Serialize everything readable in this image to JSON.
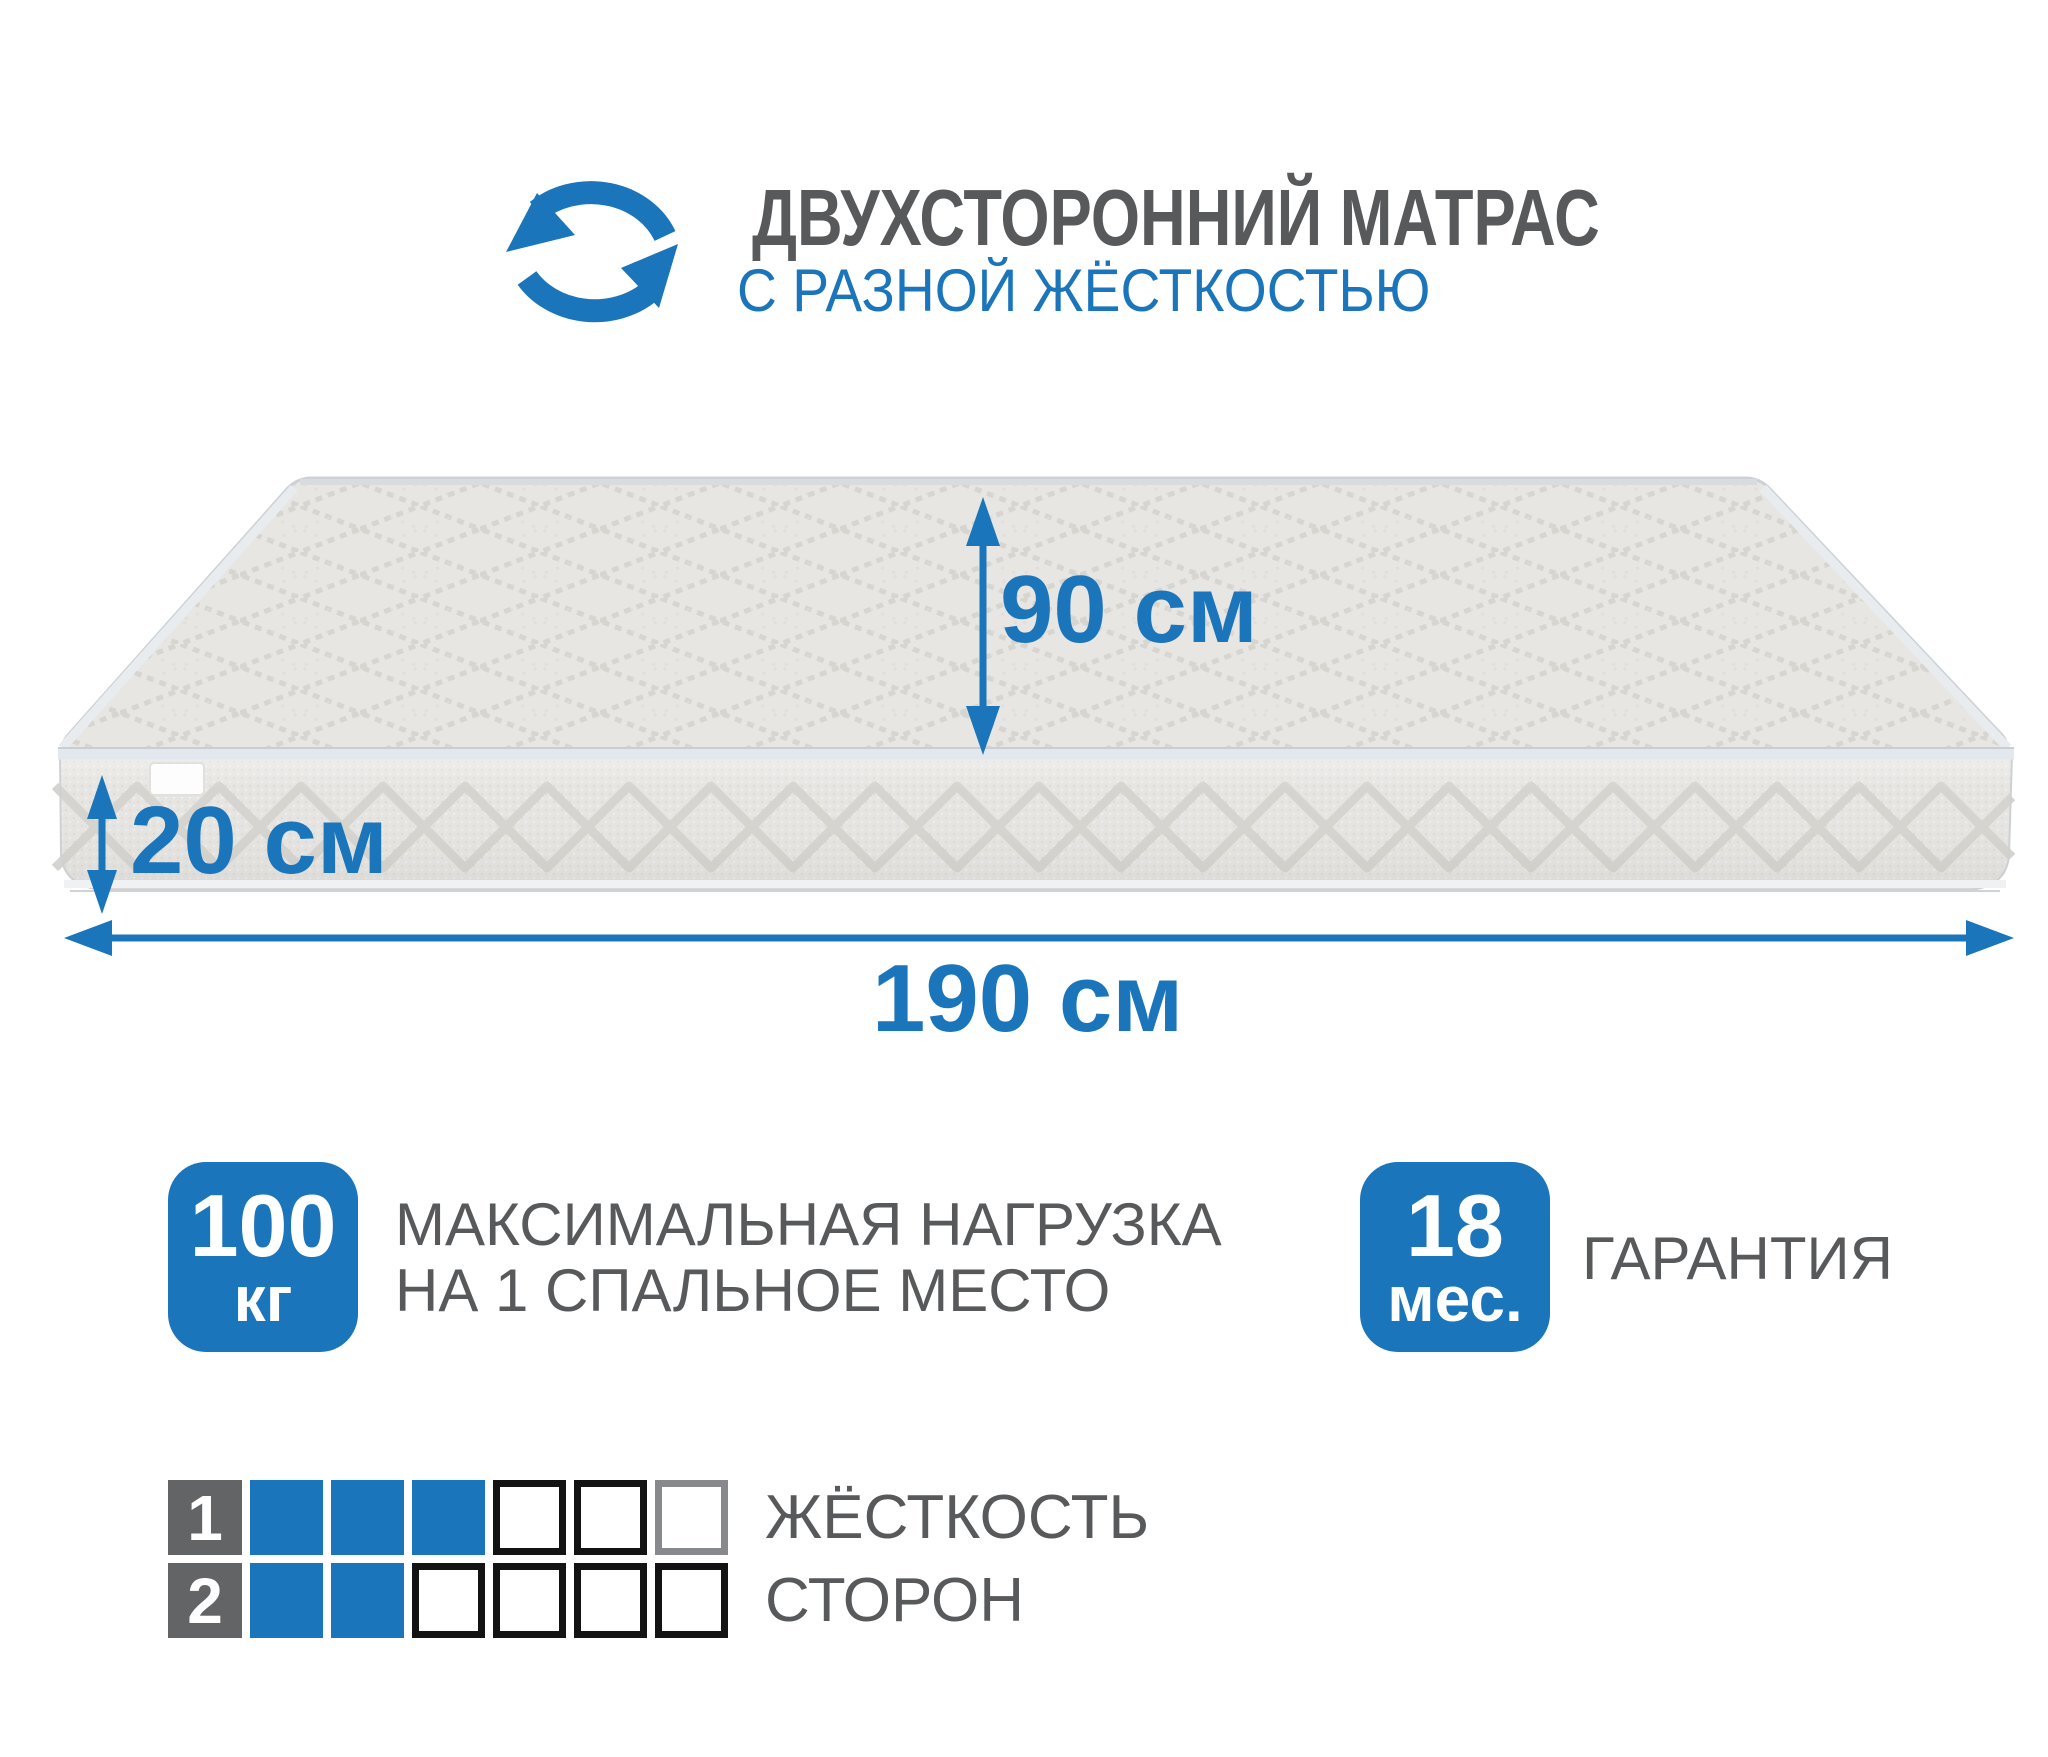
{
  "colors": {
    "accent": "#1b75bb",
    "text_gray": "#58595b",
    "number_box_gray": "#636466",
    "empty_cell_border": "#131313",
    "empty_cell_border_muted": "#87898c",
    "mattress_top": "#e7e6e3",
    "mattress_side": "#e6e5e2",
    "quilt_line": "#d3d2cc"
  },
  "header": {
    "icon": "rotate-arrows-icon",
    "title": "ДВУХСТОРОННИЙ МАТРАС",
    "subtitle": "С РАЗНОЙ ЖЁСТКОСТЬЮ"
  },
  "dimensions": {
    "depth_label": "90 см",
    "height_label": "20 см",
    "length_label": "190 см"
  },
  "load_badge": {
    "value": "100",
    "unit": "кг",
    "caption_line1": "МАКСИМАЛЬНАЯ НАГРУЗКА",
    "caption_line2": "НА 1 СПАЛЬНОЕ МЕСТО"
  },
  "warranty_badge": {
    "value": "18",
    "unit": "мес.",
    "label": "ГАРАНТИЯ"
  },
  "firmness_scale": {
    "caption_line1": "ЖЁСТКОСТЬ",
    "caption_line2": "СТОРОН",
    "rows": [
      {
        "label": "1",
        "cells": [
          "filled",
          "filled",
          "filled",
          "empty",
          "empty",
          "empty-muted"
        ]
      },
      {
        "label": "2",
        "cells": [
          "filled",
          "filled",
          "empty",
          "empty",
          "empty",
          "empty"
        ]
      }
    ]
  }
}
